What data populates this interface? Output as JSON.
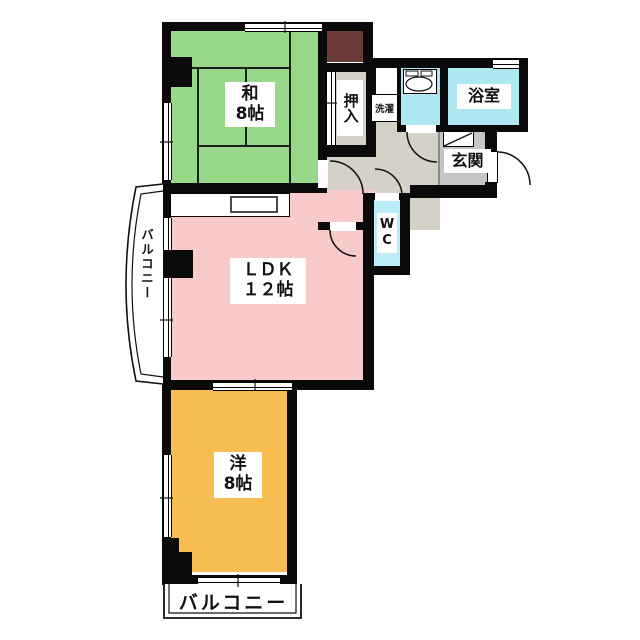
{
  "plan_title": "マンション間取り図 2LDK",
  "colors": {
    "washitsu": "#98d989",
    "ldk": "#f9caca",
    "youshitsu": "#f8bd52",
    "water": "#aee6f1",
    "wc": "#b9ecf6",
    "hallway": "#d5d1c6",
    "oshiire": "#d5d1c6",
    "genkan": "#c6c6c6",
    "alcove": "#693b34",
    "wall": "#0a0a0a"
  },
  "rooms": {
    "washitsu": {
      "line1": "和",
      "line2": "8帖"
    },
    "ldk": {
      "line1": "ＬＤＫ",
      "line2": "１２帖"
    },
    "youshitsu": {
      "line1": "洋",
      "line2": "8帖"
    },
    "oshiire": {
      "label": "押入"
    },
    "bathroom": {
      "label": "浴室"
    },
    "genkan": {
      "label": "玄関"
    },
    "laundry": {
      "label": "洗濯"
    },
    "wc": {
      "line1": "W",
      "line2": "C"
    },
    "balcony_left": {
      "label": "バルコニー"
    },
    "balcony_bottom": {
      "label": "バルコニー"
    }
  }
}
